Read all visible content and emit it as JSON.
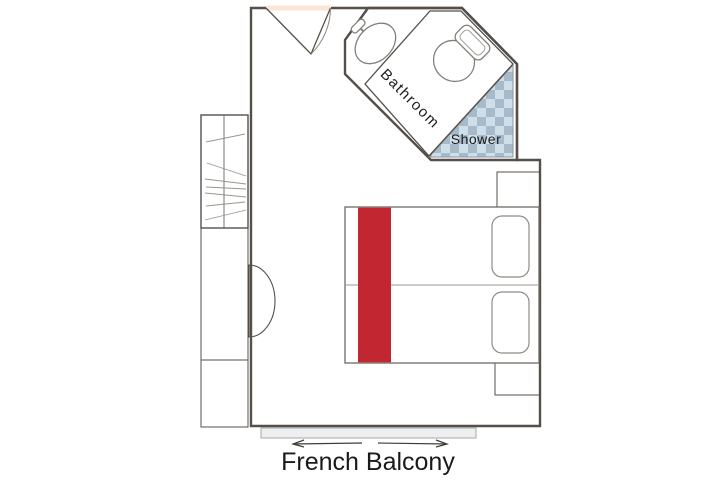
{
  "title": "French Balcony",
  "rooms": {
    "bathroom_label": "Bathroom",
    "shower_label": "Shower"
  },
  "colors": {
    "floor": "#fce5d2",
    "wall_outline": "#564f49",
    "bathroom_blue": "#9fb2c4",
    "checker_light": "#cfdfe9",
    "checker_dark": "#a6bac9",
    "bed_runner_red": "#c22630",
    "furniture_brown": "#886457",
    "stool_gray": "#999e96",
    "balcony_gray": "#edeff0",
    "arrow_color": "#3d3d3b",
    "text": "#1a1a1a",
    "white": "#ffffff"
  }
}
